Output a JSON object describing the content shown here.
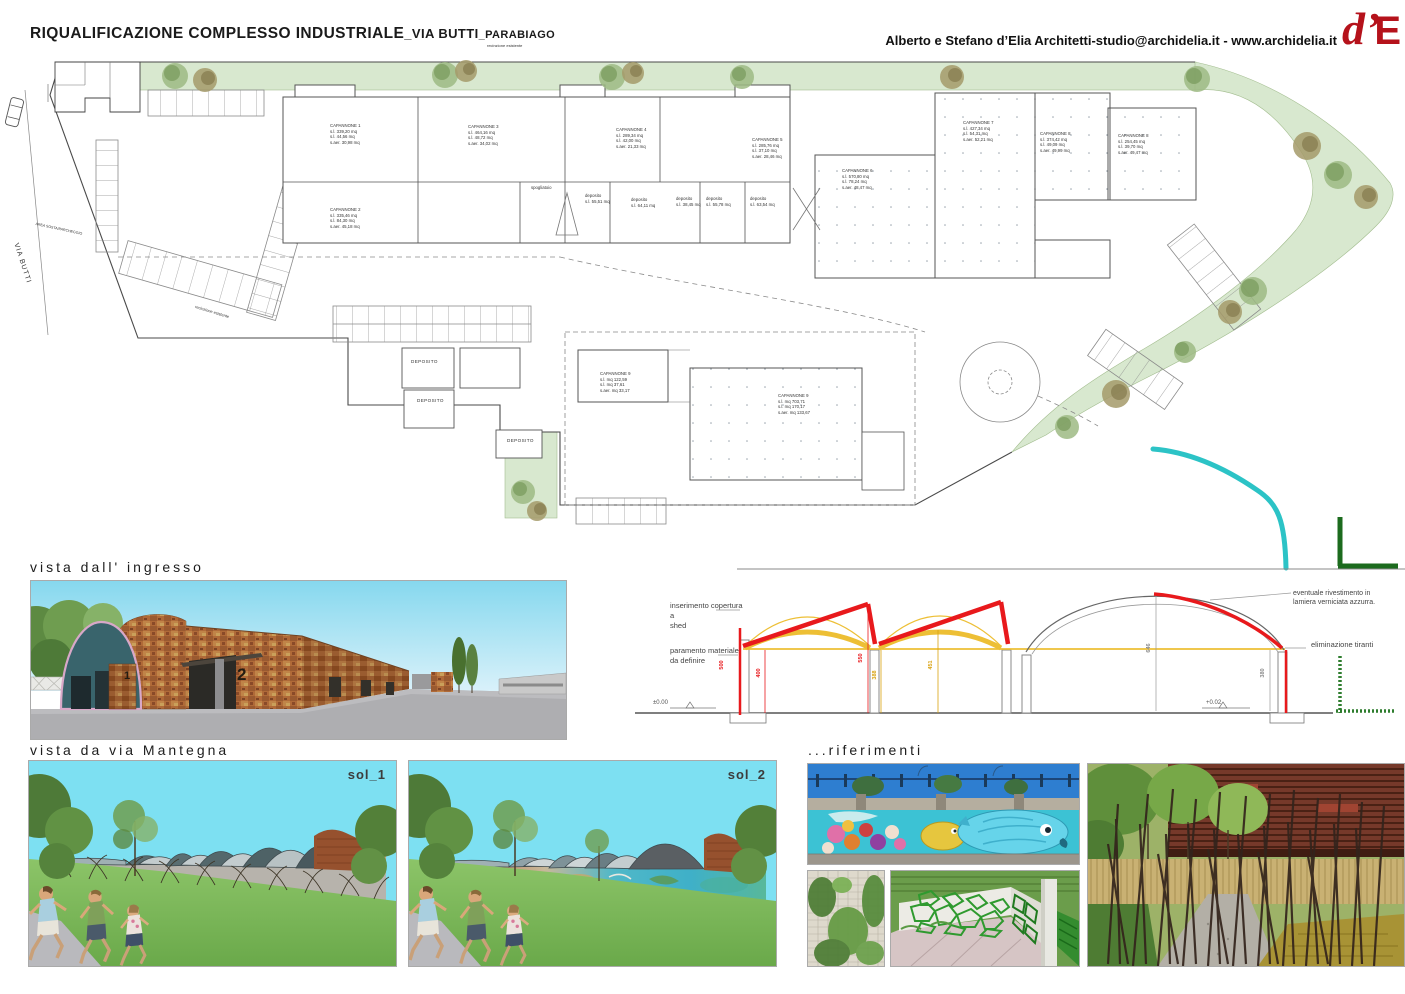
{
  "header": {
    "title_main": "RIQUALIFICAZIONE COMPLESSO INDUSTRIALE",
    "title_via": "_VIA BUTTI",
    "title_city": "_PARABIAGO",
    "credits": "Alberto e Stefano d’Elia Architetti-studio@archidelia.it - www.archidelia.it",
    "logo_d": "d’",
    "logo_e": "E"
  },
  "plan": {
    "labels": [
      {
        "text": "CAPANNONE 1\ns.l. 339,20 mq\ns.l. 44,56 mq\ns.aer. 30,98 mq",
        "x": 330,
        "y": 123
      },
      {
        "text": "CAPANNONE 2\ns.l. 335,46 mq\ns.l. 84,30 mq\ns.aer. 45,18 mq",
        "x": 330,
        "y": 207
      },
      {
        "text": "CAPANNONE 3\ns.l. 464,16 mq\ns.l. 48,72 mq\ns.aer. 34,02 mq",
        "x": 468,
        "y": 124
      },
      {
        "text": "CAPANNONE 4\ns.l. 289,34 mq\ns.l. 42,00 mq\ns.aer. 21,33 mq",
        "x": 616,
        "y": 127
      },
      {
        "text": "CAPANNONE 5\ns.l. 285,76 mq\ns.l. 37,10 mq\ns.aer. 28,46 mq",
        "x": 752,
        "y": 137
      },
      {
        "text": "CAPANNONE 6\ns.l. 570,80 mq\ns.l. 78,24 mq\ns.aer. 48,47 mq",
        "x": 842,
        "y": 168
      },
      {
        "text": "CAPANNONE 7\ns.l. 427,34 mq\ns.l. 54,31 mq\ns.aer. 52,21 mq",
        "x": 963,
        "y": 120
      },
      {
        "text": "CAPANNONE 8\ns.l. 374,42 mq\ns.l. 49,09 mq\ns.aer. 49,99 mq",
        "x": 1040,
        "y": 131
      },
      {
        "text": "CAPANNONE 8\ns.l. 254,45 mq\ns.l. 39,70 mq\ns.aer. 49,47 mq",
        "x": 1118,
        "y": 133
      },
      {
        "text": "CAPANNONE 9\ns.l. mq 122,59\ns.l. mq 37,61\ns.aer. mq 33,17",
        "x": 600,
        "y": 371
      },
      {
        "text": "CAPANNONE 9\ns.l. mq 703,71\ns.l. mq 170,17\ns.aer. mq 133,67",
        "x": 778,
        "y": 393
      },
      {
        "text": "deposito\ns.l. 55,51 mq",
        "x": 585,
        "y": 193
      },
      {
        "text": "deposito\ns.l. 64,11 mq",
        "x": 631,
        "y": 197
      },
      {
        "text": "deposito\ns.l. 38,45 mq",
        "x": 676,
        "y": 196
      },
      {
        "text": "deposito\ns.l. 55,78 mq",
        "x": 706,
        "y": 196
      },
      {
        "text": "deposito\ns.l. 63,54 mq",
        "x": 750,
        "y": 196
      },
      {
        "text": "spogliatoio",
        "x": 531,
        "y": 185
      },
      {
        "text": "DEPOSITO",
        "x": 411,
        "y": 359,
        "size": 4.6,
        "spacing": 0.4
      },
      {
        "text": "DEPOSITO",
        "x": 417,
        "y": 398,
        "size": 4.6,
        "spacing": 0.4
      },
      {
        "text": "DEPOSITO",
        "x": 507,
        "y": 438,
        "size": 4.6,
        "spacing": 0.4
      },
      {
        "text": "recinzione esistente",
        "x": 487,
        "y": 43,
        "size": 4
      },
      {
        "text": "recinzione esistente",
        "x": 196,
        "y": 304,
        "size": 4,
        "rot": 17
      },
      {
        "text": "VIA BUTTI",
        "x": 20,
        "y": 242,
        "size": 7,
        "rot": 72,
        "spacing": 1
      },
      {
        "text": "AREA SOSTA/PARCHEGGIO",
        "x": 36,
        "y": 222,
        "size": 3.6,
        "rot": 12
      }
    ]
  },
  "section": {
    "label_shed": "inserimento copertura a\nshed",
    "label_paramento": "paramento materiale\nda definire",
    "label_rivestimento": "eventuale rivestimento in\nlamiera verniciata azzurra.",
    "label_tiranti": "eliminazione tiranti",
    "level_left": "±0.00",
    "level_right": "+0.02",
    "dims": [
      {
        "value": "500",
        "x": 722,
        "y": 662,
        "c": "#e8191c"
      },
      {
        "value": "400",
        "x": 759,
        "y": 670,
        "c": "#e8191c"
      },
      {
        "value": "550",
        "x": 861,
        "y": 655,
        "c": "#e8191c"
      },
      {
        "value": "388",
        "x": 875,
        "y": 672,
        "c": "#d9a20f"
      },
      {
        "value": "451",
        "x": 931,
        "y": 662,
        "c": "#d9a20f"
      },
      {
        "value": "646",
        "x": 1149,
        "y": 645,
        "c": "#8a8a8a"
      },
      {
        "value": "380",
        "x": 1263,
        "y": 670,
        "c": "#8a8a8a"
      }
    ]
  },
  "views": {
    "ingresso_title": "vista dall' ingresso",
    "mantegna_title": "vista da via Mantegna",
    "riferimenti_title": "...riferimenti",
    "sol1_label": "sol_1",
    "sol2_label": "sol_2",
    "building_numbers": [
      "1",
      "2"
    ]
  },
  "colors": {
    "logo_red": "#b5121b",
    "section_red": "#e8191c",
    "section_yellow": "#edbf35",
    "sketch_teal": "#2cc3c6",
    "sketch_green": "#1c6b1e",
    "plan_green": "#d8e8cf",
    "render_sky": "#7de0f2",
    "render_grass": "#7fb95c",
    "render_brick": "#b06a38"
  }
}
